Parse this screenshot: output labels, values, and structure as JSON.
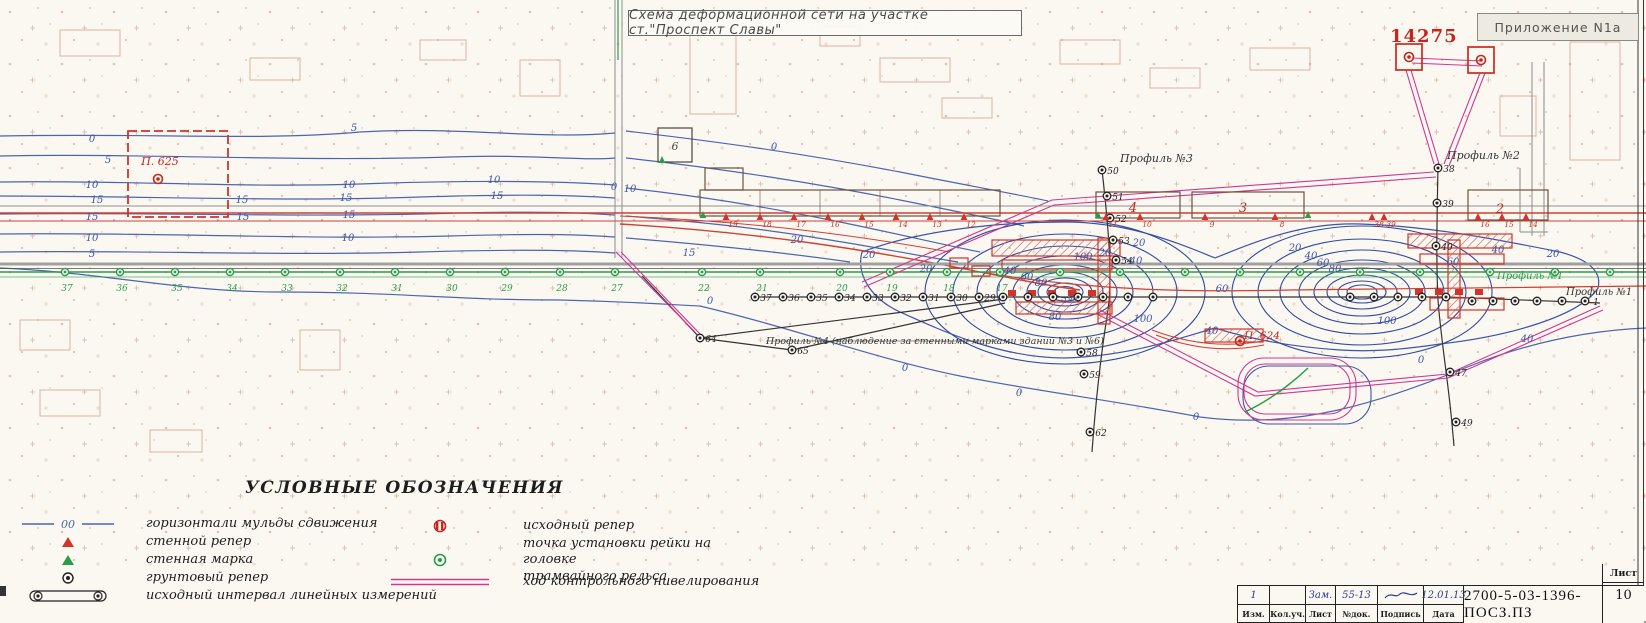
{
  "header": {
    "title": "Схема деформационной сети на участке ст.\"Проспект Славы\"",
    "appendix": "Приложение N1а",
    "red_number": "14275"
  },
  "legend": {
    "title": "УСЛОВНЫЕ ОБОЗНАЧЕНИЯ",
    "contour_sample": "00",
    "left_items": [
      {
        "icon": "contour-line",
        "label": "горизонтали мульды сдвижения"
      },
      {
        "icon": "red-triangle",
        "label": "стенной репер"
      },
      {
        "icon": "green-triangle",
        "label": "стенная марка"
      },
      {
        "icon": "ground-benchmark",
        "label": "грунтовый репер"
      },
      {
        "icon": "interval-bar",
        "label": "исходный интервал линейных измерений"
      }
    ],
    "right_items": [
      {
        "icon": "source-benchmark",
        "label": "исходный репер"
      },
      {
        "icon": "rail-point",
        "label": "точка установки рейки на головке\nтрамвайного рельса"
      },
      {
        "icon": "magenta-double-line",
        "label": "ход контрольного нивелирования"
      }
    ]
  },
  "title_block": {
    "doc_number": "2700-5-03-1396-ПОСЗ.ПЗ",
    "sheet_label": "Лист",
    "sheet_number": "10",
    "columns": [
      "Изм.",
      "Кол.уч.",
      "Лист",
      "№док.",
      "Подпись",
      "Дата"
    ],
    "revision": {
      "izm": "1",
      "koluch": "",
      "list": "Зам.",
      "doc": "55-13",
      "sign": "~",
      "date": "12.01.13"
    }
  },
  "map": {
    "accent_colors": {
      "contour_blue": "#4a66b0",
      "dense_blue": "#2e4aa0",
      "red": "#cc3328",
      "magenta": "#d1378f",
      "green": "#2a9d4a",
      "black": "#333333"
    },
    "labels": [
      {
        "t": "Профиль №3",
        "x": 1120,
        "y": 162,
        "c": "#333333",
        "s": 11,
        "a": "start"
      },
      {
        "t": "Профиль №2",
        "x": 1447,
        "y": 159,
        "c": "#333333",
        "s": 11,
        "a": "start"
      },
      {
        "t": "Профиль №1",
        "x": 1497,
        "y": 279,
        "c": "#2a9d4a",
        "s": 10,
        "a": "start"
      },
      {
        "t": "Профиль №1",
        "x": 1566,
        "y": 295,
        "c": "#333333",
        "s": 10,
        "a": "start"
      },
      {
        "t": "Профиль №4 (наблюдение за стенными марками зданий №3 и №6)",
        "x": 766,
        "y": 344,
        "c": "#333333",
        "s": 9.5,
        "a": "start"
      },
      {
        "t": "П. 625",
        "x": 160,
        "y": 165,
        "c": "#c4271d",
        "s": 11,
        "a": "middle"
      },
      {
        "t": "П. 624",
        "x": 1262,
        "y": 339,
        "c": "#c4271d",
        "s": 10.5,
        "a": "middle"
      },
      {
        "t": "4",
        "x": 1133,
        "y": 212,
        "c": "#c4271d",
        "s": 13,
        "a": "middle"
      },
      {
        "t": "3",
        "x": 1243,
        "y": 212,
        "c": "#c4271d",
        "s": 13,
        "a": "middle"
      },
      {
        "t": "2",
        "x": 1500,
        "y": 213,
        "c": "#c4271d",
        "s": 13,
        "a": "middle"
      },
      {
        "t": "6",
        "x": 675,
        "y": 150,
        "c": "#4a463f",
        "s": 11,
        "a": "middle"
      },
      {
        "t": "0",
        "x": 92,
        "y": 142
      },
      {
        "t": "5",
        "x": 108,
        "y": 163
      },
      {
        "t": "10",
        "x": 92,
        "y": 188
      },
      {
        "t": "15",
        "x": 97,
        "y": 203
      },
      {
        "t": "15",
        "x": 92,
        "y": 220
      },
      {
        "t": "10",
        "x": 92,
        "y": 241
      },
      {
        "t": "5",
        "x": 92,
        "y": 257
      },
      {
        "t": "5",
        "x": 354,
        "y": 131
      },
      {
        "t": "10",
        "x": 349,
        "y": 188
      },
      {
        "t": "15",
        "x": 242,
        "y": 203
      },
      {
        "t": "15",
        "x": 346,
        "y": 201
      },
      {
        "t": "10",
        "x": 494,
        "y": 183
      },
      {
        "t": "15",
        "x": 497,
        "y": 199
      },
      {
        "t": "15",
        "x": 243,
        "y": 220
      },
      {
        "t": "15",
        "x": 349,
        "y": 218
      },
      {
        "t": "10",
        "x": 348,
        "y": 241
      },
      {
        "t": "10",
        "x": 630,
        "y": 192
      },
      {
        "t": "0",
        "x": 614,
        "y": 190
      },
      {
        "t": "15",
        "x": 689,
        "y": 256
      },
      {
        "t": "0",
        "x": 774,
        "y": 150
      },
      {
        "t": "20",
        "x": 797,
        "y": 243
      },
      {
        "t": "20",
        "x": 926,
        "y": 272
      },
      {
        "t": "0",
        "x": 710,
        "y": 304
      },
      {
        "t": "20",
        "x": 1105,
        "y": 256
      },
      {
        "t": "40",
        "x": 1010,
        "y": 274
      },
      {
        "t": "60",
        "x": 1027,
        "y": 280
      },
      {
        "t": "80",
        "x": 1041,
        "y": 286
      },
      {
        "t": "100",
        "x": 1083,
        "y": 260
      },
      {
        "t": "100",
        "x": 1143,
        "y": 322
      },
      {
        "t": "40",
        "x": 1136,
        "y": 264
      },
      {
        "t": "60",
        "x": 1222,
        "y": 292
      },
      {
        "t": "40",
        "x": 1212,
        "y": 334
      },
      {
        "t": "80",
        "x": 1055,
        "y": 320
      },
      {
        "t": "180",
        "x": 1070,
        "y": 303,
        "s": 7.5
      },
      {
        "t": "20",
        "x": 1139,
        "y": 246
      },
      {
        "t": "20",
        "x": 1295,
        "y": 251
      },
      {
        "t": "40",
        "x": 1311,
        "y": 259
      },
      {
        "t": "60",
        "x": 1323,
        "y": 266
      },
      {
        "t": "80",
        "x": 1335,
        "y": 272
      },
      {
        "t": "100",
        "x": 1387,
        "y": 324
      },
      {
        "t": "60",
        "x": 1453,
        "y": 265
      },
      {
        "t": "40",
        "x": 1498,
        "y": 253
      },
      {
        "t": "20",
        "x": 1553,
        "y": 257
      },
      {
        "t": "0",
        "x": 905,
        "y": 371
      },
      {
        "t": "0",
        "x": 1019,
        "y": 396
      },
      {
        "t": "0",
        "x": 1196,
        "y": 420
      },
      {
        "t": "0",
        "x": 1421,
        "y": 363
      },
      {
        "t": "40",
        "x": 1527,
        "y": 342
      },
      {
        "t": "20",
        "x": 869,
        "y": 258
      }
    ],
    "green_points": [
      {
        "x": 65,
        "n": "37"
      },
      {
        "x": 120,
        "n": "36"
      },
      {
        "x": 175,
        "n": "35"
      },
      {
        "x": 230,
        "n": "34"
      },
      {
        "x": 285,
        "n": "33"
      },
      {
        "x": 340,
        "n": "32"
      },
      {
        "x": 395,
        "n": "31"
      },
      {
        "x": 450,
        "n": "30"
      },
      {
        "x": 505,
        "n": "29"
      },
      {
        "x": 560,
        "n": "28"
      },
      {
        "x": 615,
        "n": "27"
      },
      {
        "x": 702,
        "n": "22"
      },
      {
        "x": 760,
        "n": "21"
      },
      {
        "x": 840,
        "n": "20"
      },
      {
        "x": 890,
        "n": "19"
      },
      {
        "x": 947,
        "n": "18"
      },
      {
        "x": 1000,
        "n": "17"
      },
      {
        "x": 1060,
        "n": ""
      },
      {
        "x": 1120,
        "n": ""
      },
      {
        "x": 1185,
        "n": ""
      },
      {
        "x": 1240,
        "n": ""
      },
      {
        "x": 1300,
        "n": ""
      },
      {
        "x": 1360,
        "n": ""
      },
      {
        "x": 1420,
        "n": ""
      },
      {
        "x": 1490,
        "n": ""
      },
      {
        "x": 1555,
        "n": ""
      },
      {
        "x": 1610,
        "n": ""
      }
    ],
    "black_points": [
      {
        "x": 755,
        "y": 297,
        "n": "37"
      },
      {
        "x": 783,
        "y": 297,
        "n": "36"
      },
      {
        "x": 811,
        "y": 297,
        "n": "35"
      },
      {
        "x": 839,
        "y": 297,
        "n": "34"
      },
      {
        "x": 867,
        "y": 297,
        "n": "33"
      },
      {
        "x": 895,
        "y": 297,
        "n": "32"
      },
      {
        "x": 923,
        "y": 297,
        "n": "31"
      },
      {
        "x": 951,
        "y": 297,
        "n": "30"
      },
      {
        "x": 979,
        "y": 297,
        "n": "29"
      },
      {
        "x": 1003,
        "y": 297,
        "n": ""
      },
      {
        "x": 1028,
        "y": 297,
        "n": ""
      },
      {
        "x": 1053,
        "y": 297,
        "n": ""
      },
      {
        "x": 1078,
        "y": 297,
        "n": ""
      },
      {
        "x": 1103,
        "y": 297,
        "n": ""
      },
      {
        "x": 1128,
        "y": 297,
        "n": ""
      },
      {
        "x": 1153,
        "y": 297,
        "n": ""
      },
      {
        "x": 1350,
        "y": 297,
        "n": ""
      },
      {
        "x": 1374,
        "y": 297,
        "n": ""
      },
      {
        "x": 1398,
        "y": 297,
        "n": ""
      },
      {
        "x": 1422,
        "y": 297,
        "n": ""
      },
      {
        "x": 1446,
        "y": 297,
        "n": ""
      },
      {
        "x": 1472,
        "y": 301,
        "n": ""
      },
      {
        "x": 1493,
        "y": 301,
        "n": ""
      },
      {
        "x": 1515,
        "y": 301,
        "n": ""
      },
      {
        "x": 1537,
        "y": 301,
        "n": ""
      },
      {
        "x": 1562,
        "y": 301,
        "n": ""
      },
      {
        "x": 1585,
        "y": 301,
        "n": "1"
      },
      {
        "x": 1102,
        "y": 170,
        "n": "50"
      },
      {
        "x": 1107,
        "y": 196,
        "n": "51"
      },
      {
        "x": 1110,
        "y": 218,
        "n": "52"
      },
      {
        "x": 1113,
        "y": 240,
        "n": "53"
      },
      {
        "x": 1116,
        "y": 260,
        "n": "54"
      },
      {
        "x": 1081,
        "y": 352,
        "n": "58"
      },
      {
        "x": 1084,
        "y": 374,
        "n": "59"
      },
      {
        "x": 1090,
        "y": 432,
        "n": "62"
      },
      {
        "x": 1438,
        "y": 168,
        "n": "38"
      },
      {
        "x": 1437,
        "y": 203,
        "n": "39"
      },
      {
        "x": 1436,
        "y": 246,
        "n": "40"
      },
      {
        "x": 1450,
        "y": 372,
        "n": "47"
      },
      {
        "x": 1456,
        "y": 422,
        "n": "49"
      },
      {
        "x": 700,
        "y": 338,
        "n": "64"
      },
      {
        "x": 792,
        "y": 350,
        "n": "65"
      }
    ],
    "red_points": [
      {
        "x": 158,
        "y": 179
      },
      {
        "x": 1409,
        "y": 57
      },
      {
        "x": 1481,
        "y": 60
      },
      {
        "x": 1240,
        "y": 341
      }
    ],
    "red_triangles": [
      {
        "x": 726,
        "n": "19"
      },
      {
        "x": 760,
        "n": "18"
      },
      {
        "x": 794,
        "n": "17"
      },
      {
        "x": 828,
        "n": "16"
      },
      {
        "x": 862,
        "n": "15"
      },
      {
        "x": 896,
        "n": "14"
      },
      {
        "x": 930,
        "n": "13"
      },
      {
        "x": 964,
        "n": "12"
      },
      {
        "x": 1106,
        "n": "11"
      },
      {
        "x": 1140,
        "n": "10"
      },
      {
        "x": 1205,
        "n": "9"
      },
      {
        "x": 1275,
        "n": "8"
      },
      {
        "x": 1478,
        "n": "16"
      },
      {
        "x": 1502,
        "n": "15"
      },
      {
        "x": 1526,
        "n": "14"
      },
      {
        "x": 1372,
        "n": "38"
      },
      {
        "x": 1384,
        "n": "39"
      }
    ],
    "green_triangles": [
      {
        "x": 703,
        "y": 218
      },
      {
        "x": 1098,
        "y": 218
      },
      {
        "x": 1308,
        "y": 218
      },
      {
        "x": 662,
        "y": 163
      }
    ]
  }
}
